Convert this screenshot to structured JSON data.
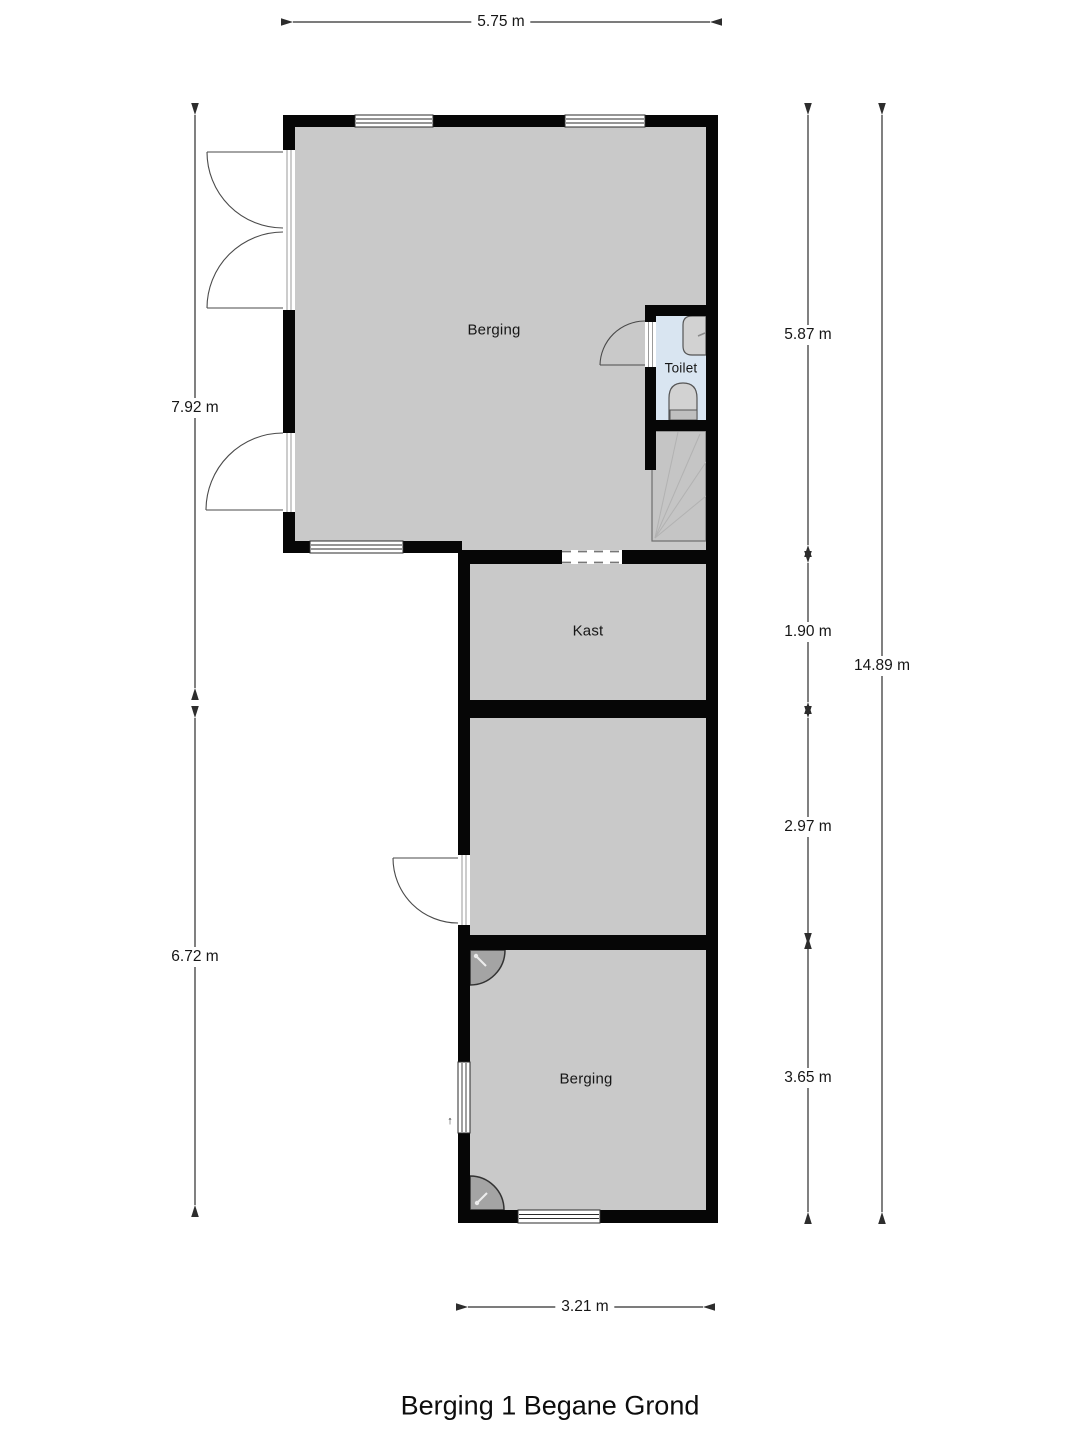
{
  "title": "Berging 1 Begane Grond",
  "rooms": {
    "berging_main": "Berging",
    "toilet": "Toilet",
    "kast": "Kast",
    "berging_bottom": "Berging"
  },
  "dimensions": {
    "top_width": "5.75 m",
    "left_upper_height": "7.92 m",
    "left_lower_height": "6.72 m",
    "right_seg_1": "5.87 m",
    "right_seg_2": "1.90 m",
    "right_seg_3": "2.97 m",
    "right_seg_4": "3.65 m",
    "right_total_height": "14.89 m",
    "bottom_width": "3.21 m"
  },
  "annotations": {
    "door_swing_marker": "↑"
  },
  "colors": {
    "floor": "#c9c9c9",
    "toilet_floor": "#d9e5f1",
    "wall": "#060606",
    "dim_line": "#2d2d2d",
    "background": "#ffffff"
  }
}
